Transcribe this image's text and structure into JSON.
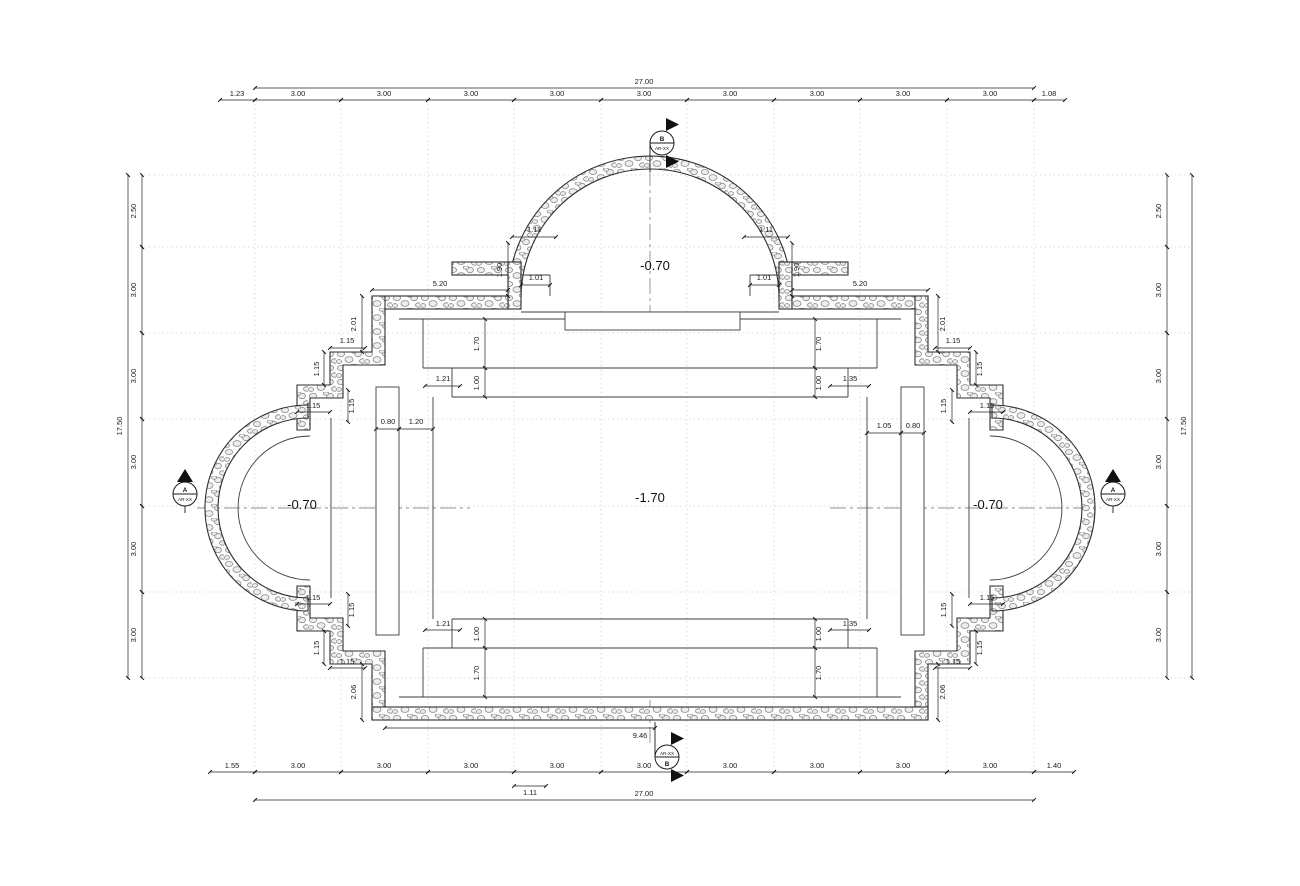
{
  "values": {
    "overall_w": "27.00",
    "overall_h": "17.50",
    "seg_300": "3.00",
    "seg_250": "2.50",
    "off_123": "1.23",
    "off_108": "1.08",
    "off_155": "1.55",
    "off_140": "1.40",
    "d111": "1.11",
    "d190": "1.90",
    "d101": "1.01",
    "d520": "5.20",
    "d201": "2.01",
    "d206": "2.06",
    "d115": "1.15",
    "d170": "1.70",
    "d100": "1.00",
    "d121": "1.21",
    "d135": "1.35",
    "d080": "0.80",
    "d120": "1.20",
    "d105": "1.05",
    "d946": "9.46"
  },
  "elevations": {
    "apse": "-0.70",
    "hall": "-1.70"
  },
  "markers": {
    "a": {
      "letter": "A",
      "sheet": "AR-XX"
    },
    "b": {
      "letter": "B",
      "sheet": "AR-XX"
    }
  },
  "colors": {
    "line": "#2f2f2f",
    "grid": "#cfcfcf",
    "centerline": "#8f8f8f"
  }
}
